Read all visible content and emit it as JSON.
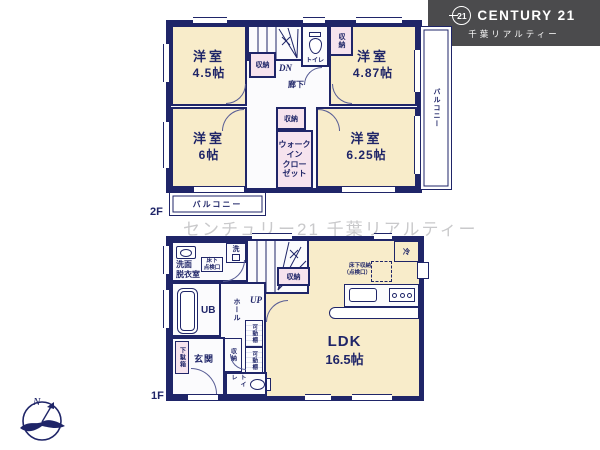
{
  "colors": {
    "wall": "#1f2568",
    "room_fill": "#f8ecca",
    "closet_fill": "#f6e3ee",
    "corridor_fill": "#fbfbfd",
    "logo_bg": "#4b4b4d",
    "watermark": "#c9c9cb"
  },
  "logo": {
    "circle_text": "21",
    "brand": "CENTURY 21",
    "subtitle": "千葉リアルティー"
  },
  "watermark": "センチュリー21 千葉リアルティー",
  "compass": {
    "north": "N"
  },
  "floor2": {
    "label": "2F",
    "room_nw": {
      "name": "洋室",
      "size": "4.5帖"
    },
    "room_ne": {
      "name": "洋室",
      "size": "4.87帖"
    },
    "room_sw": {
      "name": "洋室",
      "size": "6帖"
    },
    "room_se": {
      "name": "洋室",
      "size": "6.25帖"
    },
    "closet_by_stairs": "収納",
    "closet_ne": "収納",
    "closet_center": "収納",
    "wic": {
      "line1": "ウォーク",
      "line2": "イン",
      "line3": "クロー",
      "line4": "ゼット"
    },
    "toilet": "トイレ",
    "hallway": "廊下",
    "stairs_dn": "DN",
    "balcony_right": "バルコニー",
    "balcony_bottom": "バルコニー"
  },
  "floor1": {
    "label": "1F",
    "ldk": {
      "name": "LDK",
      "size": "16.5帖"
    },
    "washroom": {
      "line1": "洗面",
      "line2": "脱衣室"
    },
    "laundry": "洗",
    "inspection": {
      "line1": "床下",
      "line2": "点検口"
    },
    "underfloor_storage": {
      "line1": "床下収納",
      "line2": "（点検口）"
    },
    "fridge": "冷",
    "unit_bath": "UB",
    "stairs_up": "UP",
    "closet_by_stairs": "収納",
    "hall": "ホール",
    "closet_hall": "収納",
    "shelf_upper": "可動棚",
    "shelf_lower": "可動棚",
    "shoe_cabinet": "下駄箱",
    "entrance": "玄関",
    "toilet": "トイレ"
  }
}
